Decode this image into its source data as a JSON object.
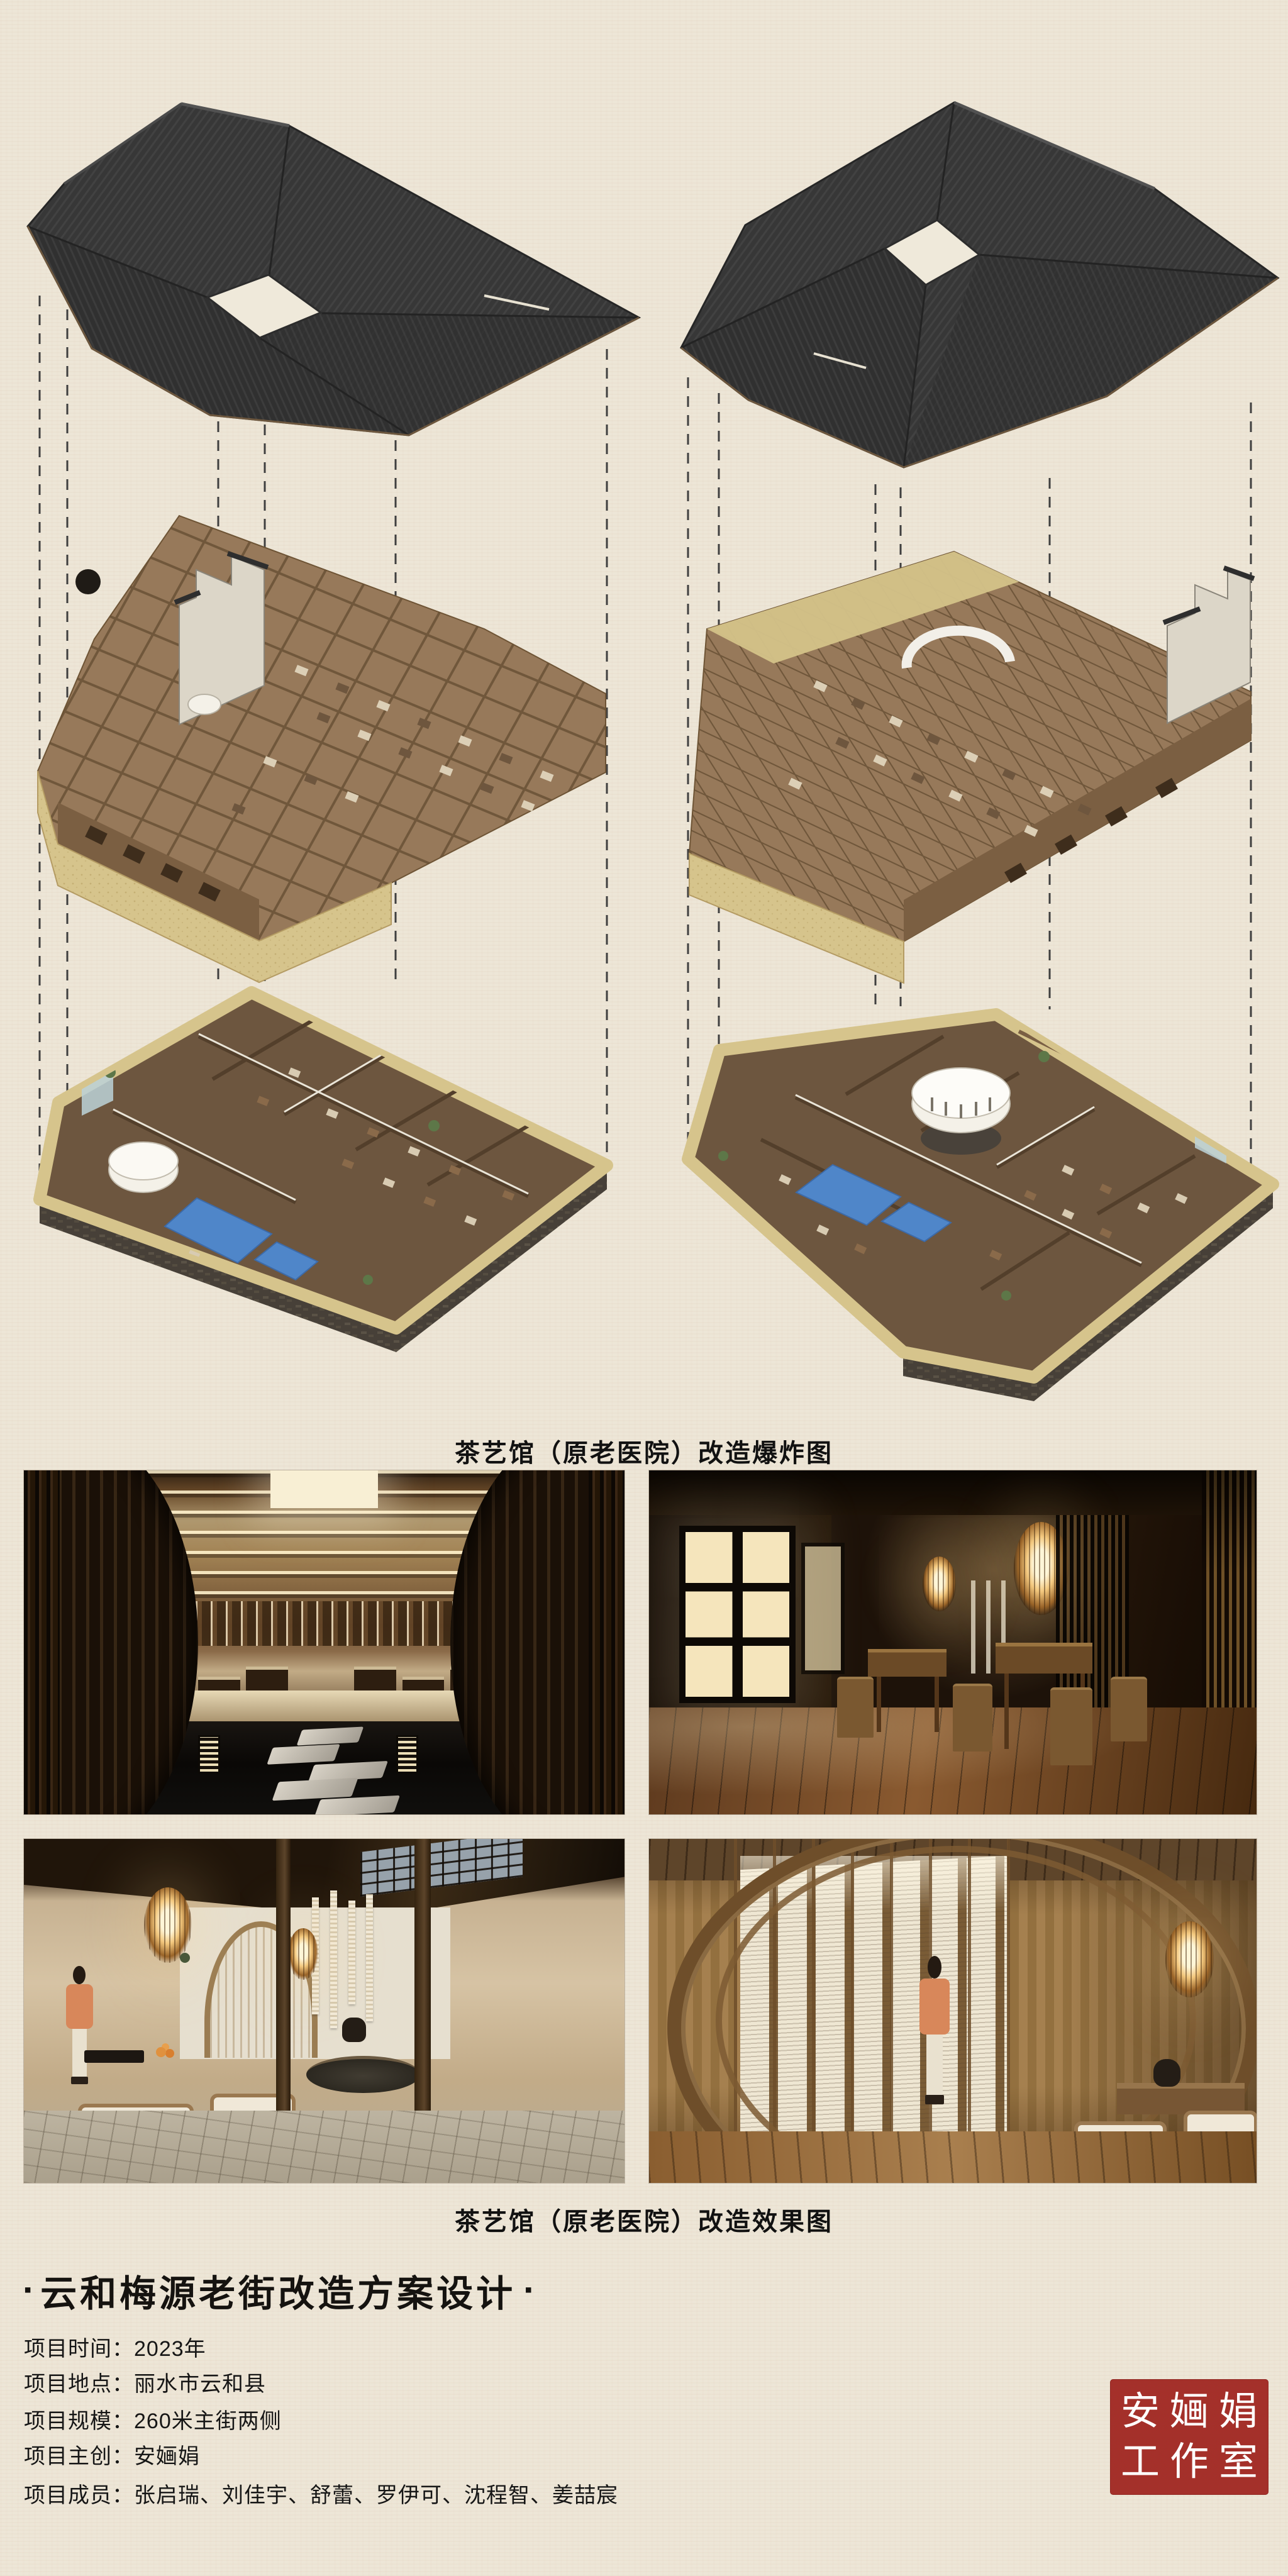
{
  "board": {
    "exploded_caption": "茶艺馆（原老医院）改造爆炸图",
    "renders_caption": "茶艺馆（原老医院）改造效果图",
    "title_bullet": "▪",
    "title": "云和梅源老街改造方案设计"
  },
  "project_info": {
    "colon": "：",
    "items": [
      {
        "label": "项目时间",
        "value": "2023年"
      },
      {
        "label": "项目地点",
        "value": "丽水市云和县"
      },
      {
        "label": "项目规模",
        "value": "260米主街两侧"
      },
      {
        "label": "项目主创",
        "value": "安婳娟"
      },
      {
        "label": "项目成员",
        "value": "张启瑞、刘佳宇、舒蕾、罗伊可、沈程智、姜喆宸"
      }
    ]
  },
  "seal": {
    "row1": "安婳娟",
    "row2": "工作室",
    "color": "#a4302a",
    "text_color": "#ffffff"
  },
  "colors": {
    "paper": "#ede6d7",
    "roof": "#373737",
    "wood": "#97795a",
    "earth_wall": "#d6c48c",
    "stone": "#474038",
    "water": "#4f86c9",
    "seal_red": "#a4302a"
  }
}
